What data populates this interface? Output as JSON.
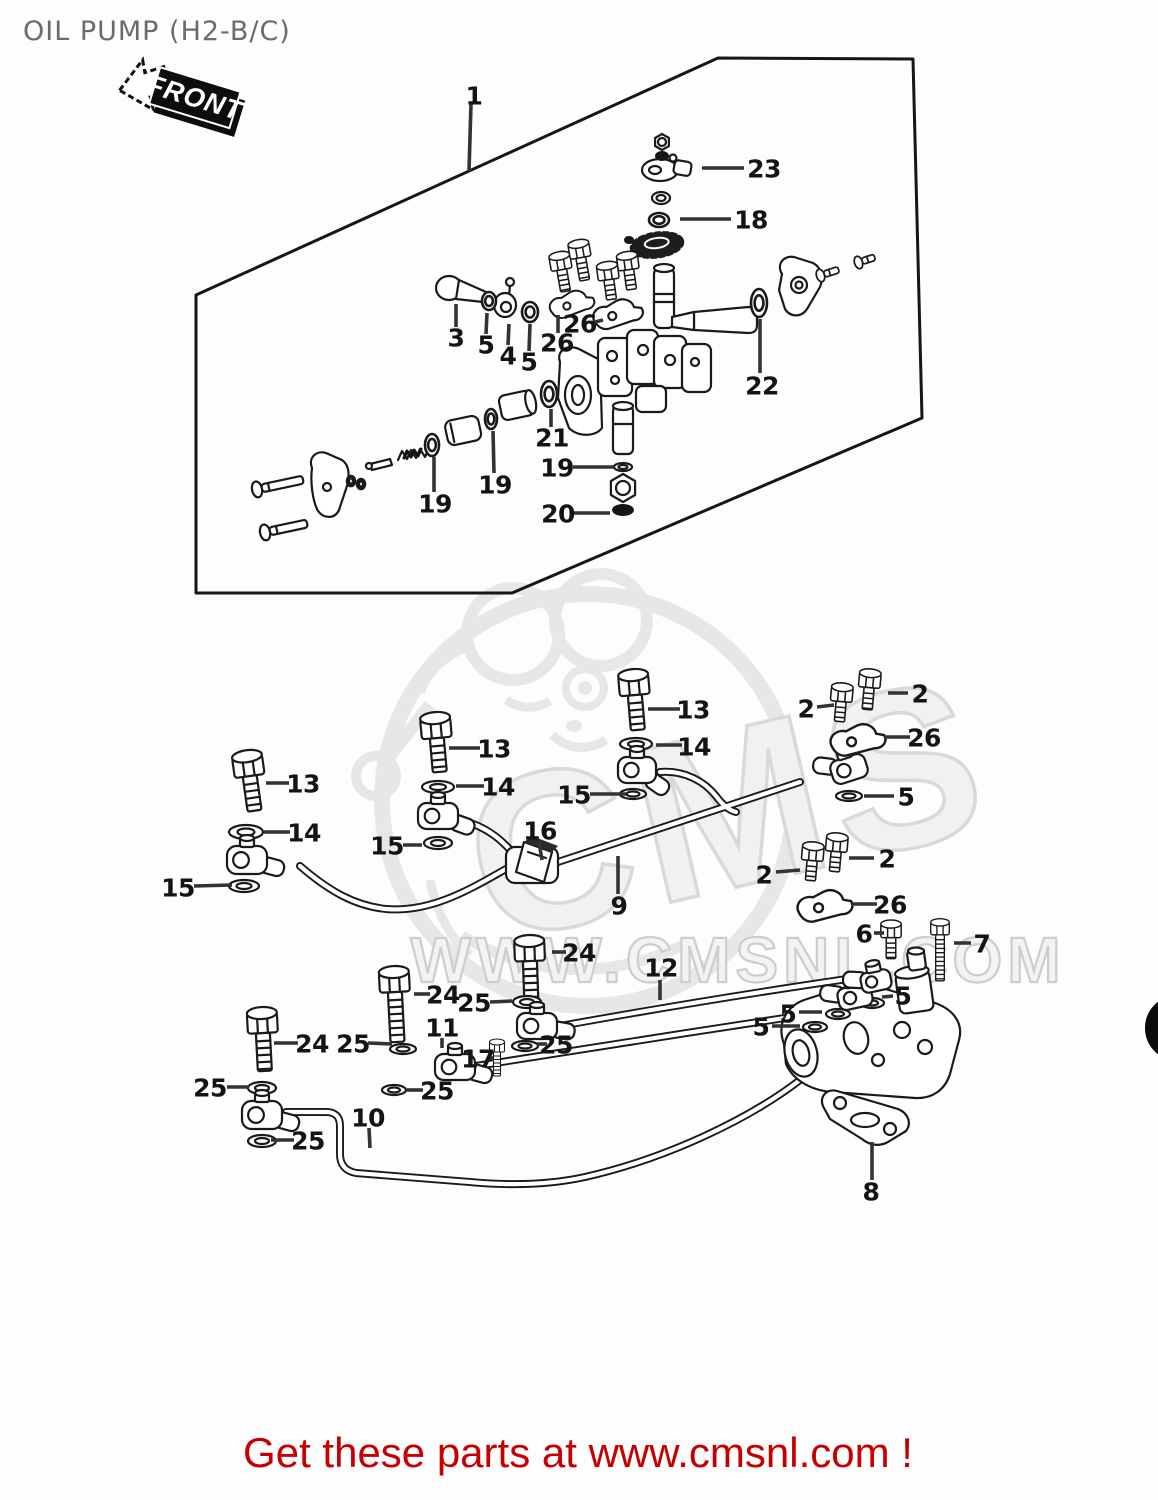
{
  "header": {
    "title": "OIL PUMP (H2-B/C)"
  },
  "front_badge": {
    "label": "FRONT"
  },
  "footer": {
    "message": "Get these parts at www.cmsnl.com !"
  },
  "watermark": {
    "logo_text": "CMS",
    "url_text": "WWW.CMSNL.COM"
  },
  "colors": {
    "line": "#1a1a1a",
    "leader": "#333333",
    "label": "#141414",
    "title_gray": "#6b6b6b",
    "footer_red": "#c60000",
    "wm_light": "#e7e7e7",
    "bg": "#fdfdfd"
  },
  "edge_mark": {
    "cx": 1178,
    "cy": 1028,
    "r": 26,
    "sw": 14
  },
  "diagram": {
    "panel_outline": [
      [
        196,
        295
      ],
      [
        718,
        58
      ],
      [
        913,
        59
      ],
      [
        922,
        418
      ],
      [
        512,
        593
      ],
      [
        196,
        593
      ]
    ],
    "callouts": [
      {
        "t": "1",
        "x": 474,
        "y": 96,
        "l": [
          471,
          104,
          469,
          171
        ]
      },
      {
        "t": "23",
        "x": 764,
        "y": 169,
        "l": [
          702,
          168,
          744,
          168
        ]
      },
      {
        "t": "18",
        "x": 751,
        "y": 220,
        "l": [
          680,
          219,
          731,
          219
        ]
      },
      {
        "t": "3",
        "x": 456,
        "y": 338,
        "l": [
          456,
          304,
          456,
          327
        ]
      },
      {
        "t": "5",
        "x": 486,
        "y": 345,
        "l": [
          487,
          313,
          486,
          334
        ]
      },
      {
        "t": "4",
        "x": 508,
        "y": 356,
        "l": [
          509,
          324,
          508,
          345
        ]
      },
      {
        "t": "5",
        "x": 529,
        "y": 362,
        "l": [
          530,
          324,
          529,
          351
        ]
      },
      {
        "t": "26",
        "x": 580,
        "y": 324,
        "l": [
          591,
          323,
          603,
          320
        ]
      },
      {
        "t": "26",
        "x": 557,
        "y": 343,
        "l": [
          558,
          315,
          558,
          333
        ]
      },
      {
        "t": "21",
        "x": 552,
        "y": 438,
        "l": [
          551,
          409,
          551,
          427
        ]
      },
      {
        "t": "19",
        "x": 495,
        "y": 485,
        "l": [
          493,
          431,
          494,
          473
        ]
      },
      {
        "t": "19",
        "x": 435,
        "y": 504,
        "l": [
          434,
          457,
          434,
          492
        ]
      },
      {
        "t": "19",
        "x": 557,
        "y": 468,
        "l": [
          573,
          467,
          614,
          467
        ]
      },
      {
        "t": "20",
        "x": 558,
        "y": 514,
        "l": [
          572,
          513,
          610,
          513
        ]
      },
      {
        "t": "22",
        "x": 762,
        "y": 386,
        "l": [
          760,
          319,
          760,
          373
        ]
      },
      {
        "t": "13",
        "x": 303,
        "y": 784,
        "l": [
          266,
          783,
          289,
          783
        ]
      },
      {
        "t": "14",
        "x": 304,
        "y": 833,
        "l": [
          264,
          832,
          290,
          832
        ]
      },
      {
        "t": "15",
        "x": 178,
        "y": 888,
        "l": [
          194,
          886,
          232,
          885
        ]
      },
      {
        "t": "13",
        "x": 494,
        "y": 749,
        "l": [
          449,
          748,
          480,
          748
        ]
      },
      {
        "t": "14",
        "x": 498,
        "y": 787,
        "l": [
          456,
          786,
          484,
          786
        ]
      },
      {
        "t": "15",
        "x": 387,
        "y": 846,
        "l": [
          403,
          845,
          422,
          845
        ]
      },
      {
        "t": "16",
        "x": 540,
        "y": 831,
        "l": [
          539,
          842,
          542,
          860
        ]
      },
      {
        "t": "15",
        "x": 574,
        "y": 795,
        "l": [
          590,
          794,
          626,
          794
        ]
      },
      {
        "t": "9",
        "x": 619,
        "y": 906,
        "l": [
          618,
          856,
          618,
          894
        ]
      },
      {
        "t": "13",
        "x": 693,
        "y": 710,
        "l": [
          648,
          709,
          680,
          709
        ]
      },
      {
        "t": "14",
        "x": 694,
        "y": 747,
        "l": [
          656,
          745,
          682,
          745
        ]
      },
      {
        "t": "2",
        "x": 806,
        "y": 709,
        "l": [
          817,
          707,
          834,
          705
        ]
      },
      {
        "t": "2",
        "x": 920,
        "y": 694,
        "l": [
          888,
          693,
          908,
          693
        ]
      },
      {
        "t": "26",
        "x": 924,
        "y": 738,
        "l": [
          884,
          737,
          910,
          737
        ]
      },
      {
        "t": "5",
        "x": 906,
        "y": 797,
        "l": [
          864,
          796,
          894,
          796
        ]
      },
      {
        "t": "2",
        "x": 764,
        "y": 875,
        "l": [
          776,
          872,
          800,
          870
        ]
      },
      {
        "t": "2",
        "x": 887,
        "y": 859,
        "l": [
          849,
          858,
          874,
          858
        ]
      },
      {
        "t": "26",
        "x": 890,
        "y": 905,
        "l": [
          852,
          904,
          877,
          904
        ]
      },
      {
        "t": "6",
        "x": 864,
        "y": 934,
        "l": [
          874,
          933,
          884,
          933
        ]
      },
      {
        "t": "7",
        "x": 982,
        "y": 944,
        "l": [
          954,
          943,
          971,
          943
        ]
      },
      {
        "t": "24",
        "x": 579,
        "y": 953,
        "l": [
          552,
          952,
          566,
          952
        ]
      },
      {
        "t": "12",
        "x": 661,
        "y": 968,
        "l": [
          660,
          980,
          660,
          1000
        ]
      },
      {
        "t": "24",
        "x": 443,
        "y": 995,
        "l": [
          414,
          994,
          430,
          994
        ]
      },
      {
        "t": "25",
        "x": 474,
        "y": 1003,
        "l": [
          490,
          1002,
          512,
          1001
        ]
      },
      {
        "t": "11",
        "x": 442,
        "y": 1028,
        "l": [
          442,
          1038,
          442,
          1048
        ]
      },
      {
        "t": "24",
        "x": 312,
        "y": 1044,
        "l": [
          274,
          1043,
          298,
          1043
        ]
      },
      {
        "t": "25",
        "x": 353,
        "y": 1044,
        "l": [
          368,
          1043,
          392,
          1044
        ]
      },
      {
        "t": "17",
        "x": 478,
        "y": 1059,
        "l": [
          488,
          1058,
          493,
          1058
        ]
      },
      {
        "t": "25",
        "x": 437,
        "y": 1091,
        "l": [
          407,
          1090,
          423,
          1090
        ]
      },
      {
        "t": "25",
        "x": 556,
        "y": 1045,
        "l": [
          537,
          1044,
          547,
          1044
        ]
      },
      {
        "t": "25",
        "x": 210,
        "y": 1088,
        "l": [
          227,
          1087,
          249,
          1087
        ]
      },
      {
        "t": "25",
        "x": 308,
        "y": 1141,
        "l": [
          271,
          1140,
          294,
          1140
        ]
      },
      {
        "t": "10",
        "x": 368,
        "y": 1118,
        "l": [
          369,
          1128,
          370,
          1148
        ]
      },
      {
        "t": "5",
        "x": 903,
        "y": 996,
        "l": [
          882,
          997,
          893,
          996
        ]
      },
      {
        "t": "5",
        "x": 788,
        "y": 1014,
        "l": [
          799,
          1012,
          822,
          1012
        ]
      },
      {
        "t": "5",
        "x": 761,
        "y": 1027,
        "l": [
          772,
          1026,
          800,
          1026
        ]
      },
      {
        "t": "8",
        "x": 871,
        "y": 1192,
        "l": [
          872,
          1142,
          872,
          1180
        ]
      }
    ],
    "bolts": [
      {
        "x": 562,
        "y": 271,
        "len": 22,
        "r": -10,
        "s": 0.7
      },
      {
        "x": 581,
        "y": 259,
        "len": 23,
        "r": -10,
        "s": 0.7
      },
      {
        "x": 609,
        "y": 281,
        "len": 20,
        "r": -8,
        "s": 0.7
      },
      {
        "x": 629,
        "y": 271,
        "len": 20,
        "r": -8,
        "s": 0.7
      },
      {
        "x": 250,
        "y": 778,
        "len": 35,
        "r": -8,
        "s": 1
      },
      {
        "x": 437,
        "y": 740,
        "len": 34,
        "r": -5,
        "s": 1
      },
      {
        "x": 635,
        "y": 697,
        "len": 35,
        "r": -5,
        "s": 1
      },
      {
        "x": 841,
        "y": 703,
        "len": 20,
        "r": 5,
        "s": 0.72
      },
      {
        "x": 869,
        "y": 689,
        "len": 22,
        "r": 5,
        "s": 0.72
      },
      {
        "x": 812,
        "y": 862,
        "len": 20,
        "r": 5,
        "s": 0.72
      },
      {
        "x": 836,
        "y": 853,
        "len": 20,
        "r": 5,
        "s": 0.72
      },
      {
        "x": 530,
        "y": 963,
        "len": 42,
        "r": -2,
        "s": 1
      },
      {
        "x": 395,
        "y": 994,
        "len": 50,
        "r": -3,
        "s": 1
      },
      {
        "x": 263,
        "y": 1035,
        "len": 38,
        "r": -3,
        "s": 1
      },
      {
        "x": 891,
        "y": 939,
        "len": 21,
        "r": 0,
        "s": 0.68
      },
      {
        "x": 940,
        "y": 936,
        "len": 46,
        "r": 0,
        "s": 0.62
      },
      {
        "x": 497,
        "y": 1053,
        "len": 24,
        "r": 0,
        "s": 0.5
      }
    ],
    "washers": [
      {
        "x": 661,
        "y": 198,
        "rx": 9,
        "ry": 6
      },
      {
        "x": 623,
        "y": 467,
        "rx": 9,
        "ry": 4
      },
      {
        "x": 246,
        "y": 832,
        "rx": 17,
        "ry": 7
      },
      {
        "x": 244,
        "y": 886,
        "rx": 15,
        "ry": 6
      },
      {
        "x": 438,
        "y": 787,
        "rx": 16,
        "ry": 6
      },
      {
        "x": 438,
        "y": 843,
        "rx": 14,
        "ry": 6
      },
      {
        "x": 636,
        "y": 744,
        "rx": 16,
        "ry": 6
      },
      {
        "x": 633,
        "y": 794,
        "rx": 13,
        "ry": 5
      },
      {
        "x": 849,
        "y": 796,
        "rx": 13,
        "ry": 5
      },
      {
        "x": 527,
        "y": 1002,
        "rx": 14,
        "ry": 6
      },
      {
        "x": 525,
        "y": 1046,
        "rx": 13,
        "ry": 5
      },
      {
        "x": 403,
        "y": 1049,
        "rx": 13,
        "ry": 5
      },
      {
        "x": 394,
        "y": 1090,
        "rx": 12,
        "ry": 5
      },
      {
        "x": 262,
        "y": 1088,
        "rx": 14,
        "ry": 6
      },
      {
        "x": 262,
        "y": 1141,
        "rx": 14,
        "ry": 6
      },
      {
        "x": 872,
        "y": 1003,
        "rx": 12,
        "ry": 5
      },
      {
        "x": 838,
        "y": 1014,
        "rx": 12,
        "ry": 5
      },
      {
        "x": 815,
        "y": 1027,
        "rx": 12,
        "ry": 5
      }
    ],
    "orings": [
      {
        "x": 659,
        "y": 220,
        "rx": 10,
        "ry": 7
      },
      {
        "x": 432,
        "y": 445,
        "rx": 7,
        "ry": 11
      },
      {
        "x": 491,
        "y": 419,
        "rx": 6,
        "ry": 10
      },
      {
        "x": 549,
        "y": 394,
        "rx": 8,
        "ry": 13
      },
      {
        "x": 759,
        "y": 303,
        "rx": 8,
        "ry": 14
      },
      {
        "x": 489,
        "y": 301,
        "rx": 7,
        "ry": 9
      },
      {
        "x": 530,
        "y": 312,
        "rx": 8,
        "ry": 10
      },
      {
        "x": 351,
        "y": 481,
        "rx": 4,
        "ry": 5
      },
      {
        "x": 361,
        "y": 484,
        "rx": 4,
        "ry": 5
      }
    ],
    "hexnuts": [
      {
        "x": 662,
        "y": 142,
        "r": 8
      },
      {
        "x": 623,
        "y": 488,
        "r": 14
      }
    ],
    "darks": [
      {
        "x": 662,
        "y": 156,
        "rx": 7,
        "ry": 5
      },
      {
        "x": 623,
        "y": 510,
        "rx": 11,
        "ry": 6
      },
      {
        "x": 629,
        "y": 240,
        "rx": 5,
        "ry": 4
      }
    ],
    "banjos": [
      {
        "x": 247,
        "y": 860,
        "w": 40,
        "h": 28,
        "r": 0,
        "sa": 15
      },
      {
        "x": 438,
        "y": 816,
        "w": 40,
        "h": 26,
        "r": 0,
        "sa": 20
      },
      {
        "x": 637,
        "y": 770,
        "w": 38,
        "h": 26,
        "r": 0,
        "sa": 35
      },
      {
        "x": 849,
        "y": 769,
        "w": 36,
        "h": 24,
        "r": -18,
        "sa": -155
      },
      {
        "x": 262,
        "y": 1115,
        "w": 40,
        "h": 28,
        "r": 0,
        "sa": 15
      },
      {
        "x": 455,
        "y": 1067,
        "w": 40,
        "h": 26,
        "r": 0,
        "sa": 15
      },
      {
        "x": 537,
        "y": 1026,
        "w": 40,
        "h": 26,
        "r": 0,
        "sa": 10
      },
      {
        "x": 855,
        "y": 997,
        "w": 34,
        "h": 22,
        "r": -12,
        "sa": -160
      },
      {
        "x": 876,
        "y": 981,
        "w": 30,
        "h": 20,
        "r": -12,
        "sa": -165
      }
    ],
    "clamps": [
      {
        "x": 572,
        "y": 304,
        "r": -12,
        "s": 0.9
      },
      {
        "x": 618,
        "y": 314,
        "r": -10,
        "s": 1
      },
      {
        "x": 858,
        "y": 740,
        "r": -6,
        "s": 1.1
      },
      {
        "x": 825,
        "y": 906,
        "r": -6,
        "s": 1.1
      }
    ],
    "screws": [
      {
        "x": 259,
        "y": 489,
        "len": 42,
        "r": -12,
        "s": 1
      },
      {
        "x": 267,
        "y": 532,
        "len": 38,
        "r": -12,
        "s": 1
      },
      {
        "x": 822,
        "y": 275,
        "len": 15,
        "r": -18,
        "s": 0.8
      },
      {
        "x": 860,
        "y": 262,
        "len": 13,
        "r": -18,
        "s": 0.8
      }
    ]
  }
}
